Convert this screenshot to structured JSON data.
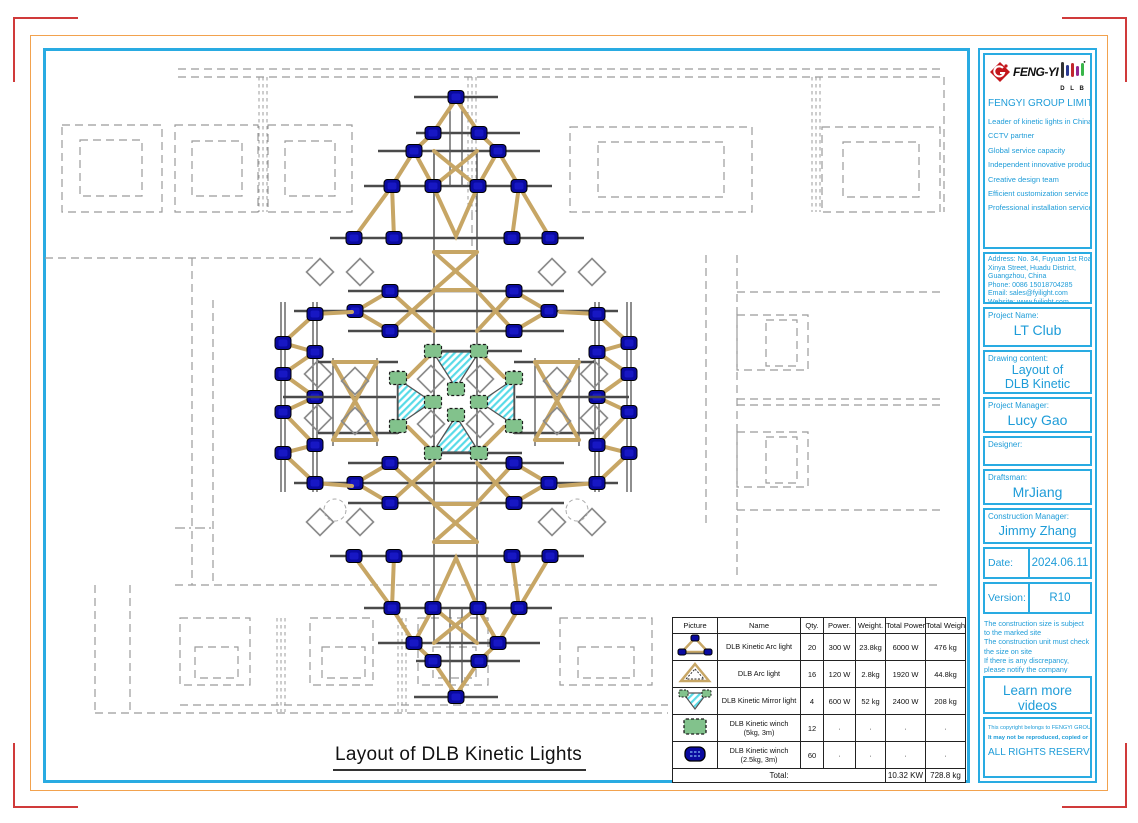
{
  "colors": {
    "accent_cyan": "#29ABE2",
    "border_orange": "#F2A24E",
    "mark_red": "#D03A3A",
    "truss_tan": "#C7A665",
    "node_blue": "#0A0AA0",
    "winch_green": "#82C28C",
    "mirror_hatch_cyan": "#59DBE8",
    "logo_red": "#C4161C"
  },
  "drawing": {
    "title": "Layout of DLB Kinetic Lights"
  },
  "title_block": {
    "company": {
      "logo_text": "FENG-YI",
      "logo_dlb": "D L B",
      "name": "FENGYI GROUP LIMITED",
      "features": [
        "Leader of kinetic lights in China",
        "CCTV partner",
        "Global service capacity",
        "Independent innovative products",
        "Creative design team",
        "Efficient customization service",
        "Professional installation service"
      ]
    },
    "address": [
      "Address:  No. 34, Fuyuan 1st Road,",
      "Xinya Street,  Huadu District,",
      "Guangzhou, China",
      "Phone:  0086 15018704285",
      "Email: sales@fyilight.com",
      "Website: www.fyilight.com"
    ],
    "project_name": {
      "label": "Project Name:",
      "value": "LT Club"
    },
    "drawing_content": {
      "label": "Drawing content:",
      "line1": "Layout of",
      "line2": "DLB Kinetic Lights"
    },
    "project_manager": {
      "label": "Project Manager:",
      "value": "Lucy Gao"
    },
    "designer": {
      "label": "Designer:",
      "value": ""
    },
    "draftsman": {
      "label": "Draftsman:",
      "value": "MrJiang"
    },
    "construction_manager": {
      "label": "Construction Manager:",
      "value": "Jimmy Zhang"
    },
    "date": {
      "label": "Date:",
      "value": "2024.06.11"
    },
    "version": {
      "label": "Version:",
      "value": "R10"
    },
    "notes": [
      "The construction size is subject to the marked site",
      "The construction unit must check the size on site",
      "If there is any discrepancy, please notify the company immediately"
    ],
    "videos": {
      "title": "Learn more videos",
      "url": "https://vimeo.com/user115756023"
    },
    "copyright": {
      "line1": "This copyright belongs to FENGYI GROUP LIMITED",
      "line2": "It may not be reproduced, copied or deleted without consent,",
      "line3": "ALL RIGHTS RESERVED."
    }
  },
  "table": {
    "headers": [
      "Picture",
      "Name",
      "Qty.",
      "Power.",
      "Weight.",
      "Total Power",
      "Total Weight."
    ],
    "rows": [
      {
        "picture_icon": "kinetic-arc-light-icon",
        "name": "DLB Kinetic Arc light",
        "name2": "",
        "qty": "20",
        "power": "300 W",
        "weight": "23.8kg",
        "total_power": "6000 W",
        "total_weight": "476 kg"
      },
      {
        "picture_icon": "arc-light-icon",
        "name": "DLB Arc light",
        "name2": "",
        "qty": "16",
        "power": "120 W",
        "weight": "2.8kg",
        "total_power": "1920 W",
        "total_weight": "44.8kg"
      },
      {
        "picture_icon": "kinetic-mirror-light-icon",
        "name": "DLB Kinetic Mirror light",
        "name2": "",
        "qty": "4",
        "power": "600 W",
        "weight": "52 kg",
        "total_power": "2400 W",
        "total_weight": "208 kg"
      },
      {
        "picture_icon": "kinetic-winch-5kg-icon",
        "name": "DLB Kinetic winch",
        "name2": "(5kg, 3m)",
        "qty": "12",
        "power": "·",
        "weight": "·",
        "total_power": "·",
        "total_weight": "·"
      },
      {
        "picture_icon": "kinetic-winch-2.5kg-icon",
        "name": "DLB Kinetic winch",
        "name2": "(2.5kg, 3m)",
        "qty": "60",
        "power": "·",
        "weight": "·",
        "total_power": "·",
        "total_weight": "·"
      }
    ],
    "total": {
      "label": "Total:",
      "power": "10.32 KW",
      "weight": "728.8 kg"
    }
  }
}
